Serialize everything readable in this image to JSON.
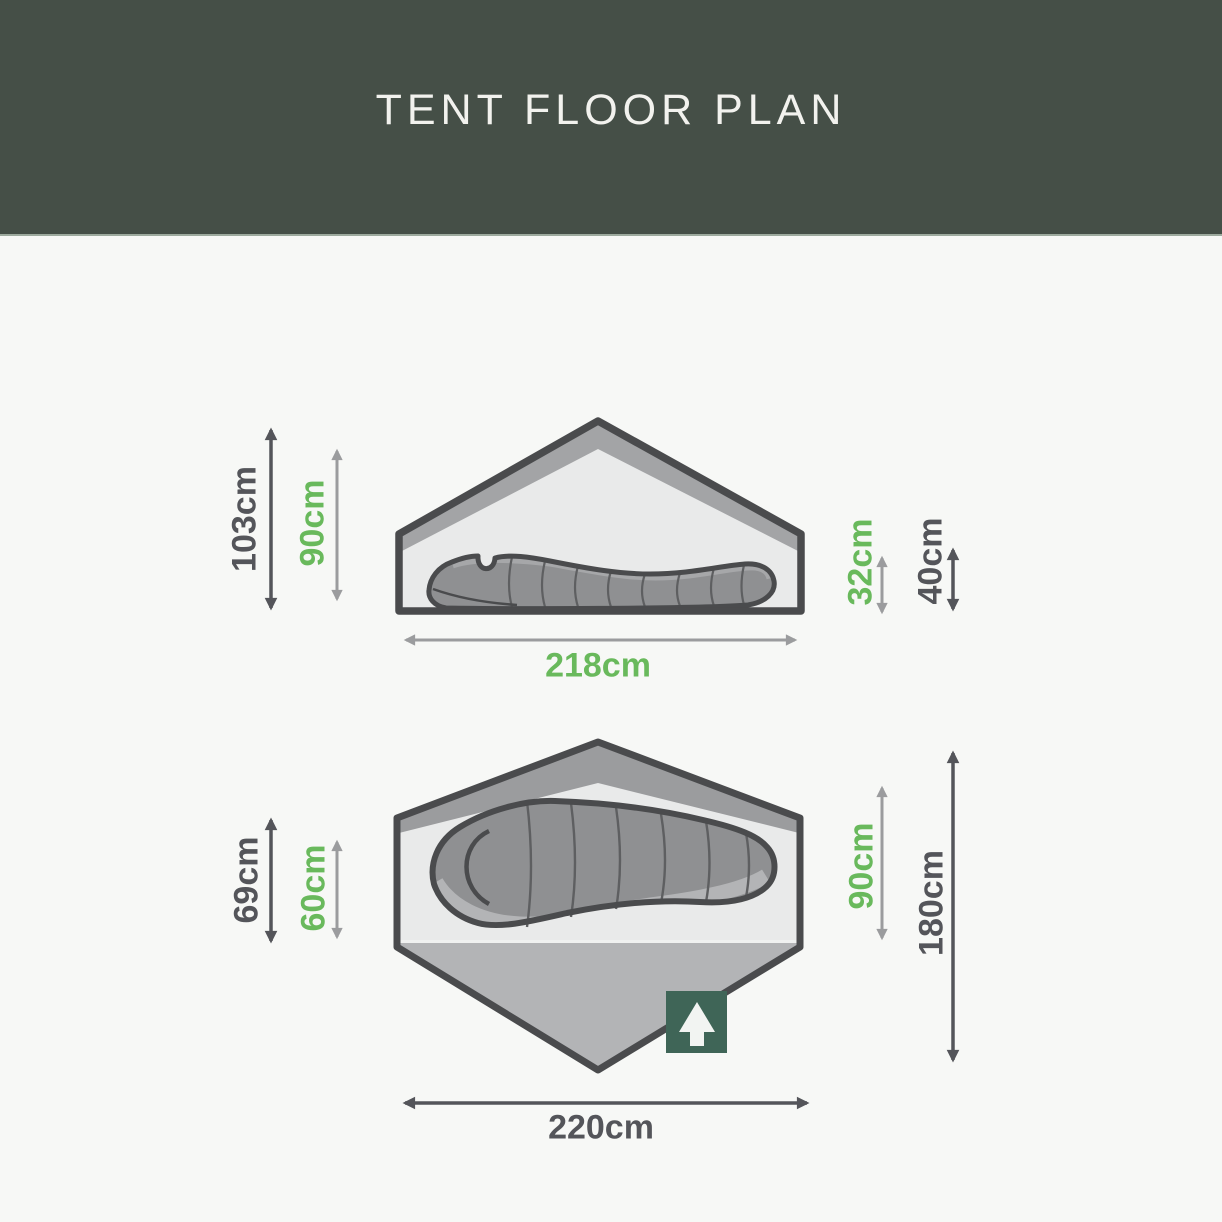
{
  "page": {
    "title": "TENT FLOOR PLAN",
    "background": "#f7f8f6",
    "header_background": "#454f47"
  },
  "colors": {
    "accent_green": "#69b95c",
    "dimension_dark": "#54555a",
    "dimension_gray": "#9b9c9e",
    "outline_dark": "#4a4b4d",
    "badge_green": "#3f6557",
    "tent_light_gray": "#e9eaea",
    "tent_band_gray": "#a3a4a6",
    "groundsheet_gray": "#b3b4b6"
  },
  "icons": {
    "entrance_arrow": "up-arrow-icon"
  },
  "side_view": {
    "outer_height": "103cm",
    "inner_height": "90cm",
    "inner_rear_height": "32cm",
    "outer_rear_height": "40cm",
    "outer_width": "218cm"
  },
  "floor_plan": {
    "outer_porch_depth": "69cm",
    "inner_porch_depth": "60cm",
    "inner_width": "90cm",
    "outer_length": "180cm",
    "outer_width": "220cm"
  }
}
